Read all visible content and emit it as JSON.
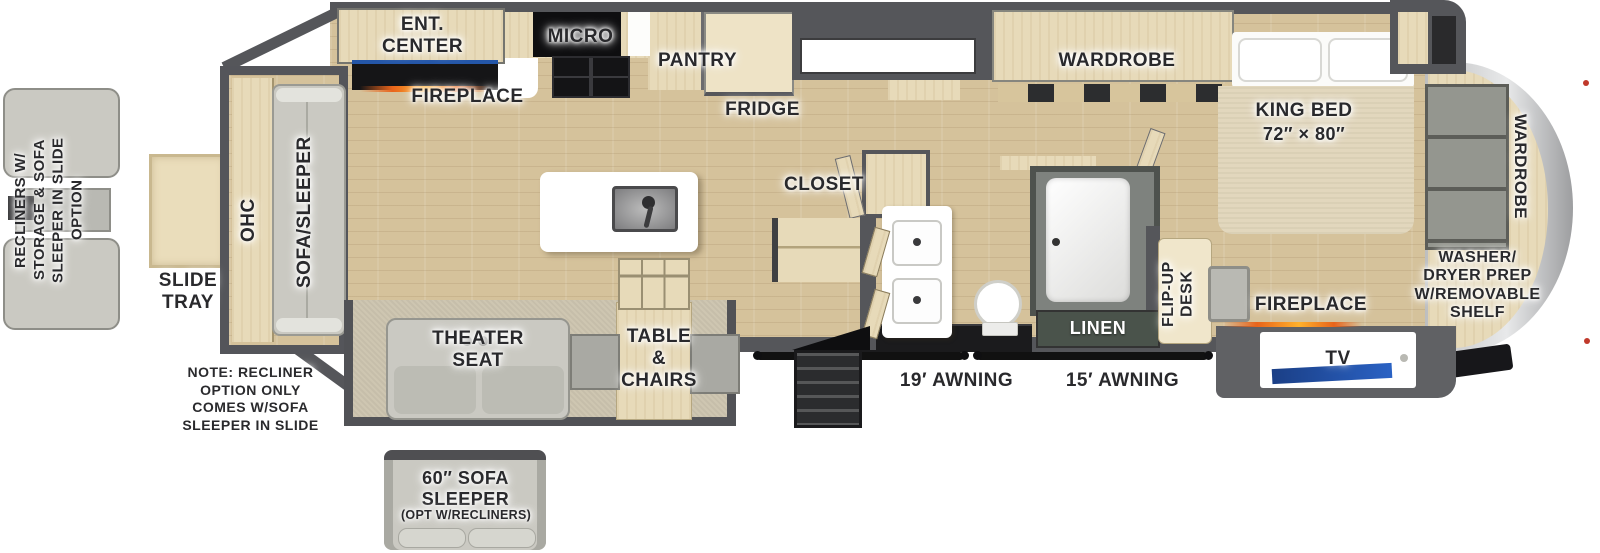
{
  "palette": {
    "wall": "#55565a",
    "floor_wood": "#d5c29b",
    "cabinet_wood": "#e7dab9",
    "fabric_gray": "#cac9c2",
    "flame_orange": "#f07818",
    "tv_blue": "#2456a8",
    "linen_green": "#4a534b",
    "front_cap_silver": "#d9dadb"
  },
  "labels": {
    "rear": {
      "ohc": "OHC",
      "sofa_sleeper": "SOFA/SLEEPER",
      "slide_tray": "SLIDE\nTRAY"
    },
    "options": {
      "recliners": "RECLINERS W/\nSTORAGE & SOFA\nSLEEPER IN SLIDE\nOPTION",
      "note": "NOTE: RECLINER\nOPTION ONLY\nCOMES W/SOFA\nSLEEPER IN SLIDE",
      "sofa_title": "60″ SOFA\nSLEEPER",
      "sofa_sub": "(OPT W/RECLINERS)"
    },
    "kitchen": {
      "ent_center": "ENT.\nCENTER",
      "fireplace": "FIREPLACE",
      "micro": "MICRO",
      "pantry": "PANTRY",
      "fridge": "FRIDGE"
    },
    "living": {
      "theater_seat": "THEATER\nSEAT",
      "table_chairs": "TABLE\n&\nCHAIRS",
      "closet": "CLOSET"
    },
    "bath": {
      "linen": "LINEN"
    },
    "bedroom": {
      "wardrobe_slide": "WARDROBE",
      "king_bed": "KING BED",
      "king_size": "72″ × 80″",
      "flip_up_desk": "FLIP-UP\nDESK",
      "fireplace": "FIREPLACE",
      "tv": "TV",
      "wardrobe_front": "WARDROBE",
      "washer_dryer": "WASHER/\nDRYER PREP\nW/REMOVABLE\nSHELF"
    },
    "exterior": {
      "awning_19": "19′ AWNING",
      "awning_15": "15′ AWNING"
    }
  }
}
